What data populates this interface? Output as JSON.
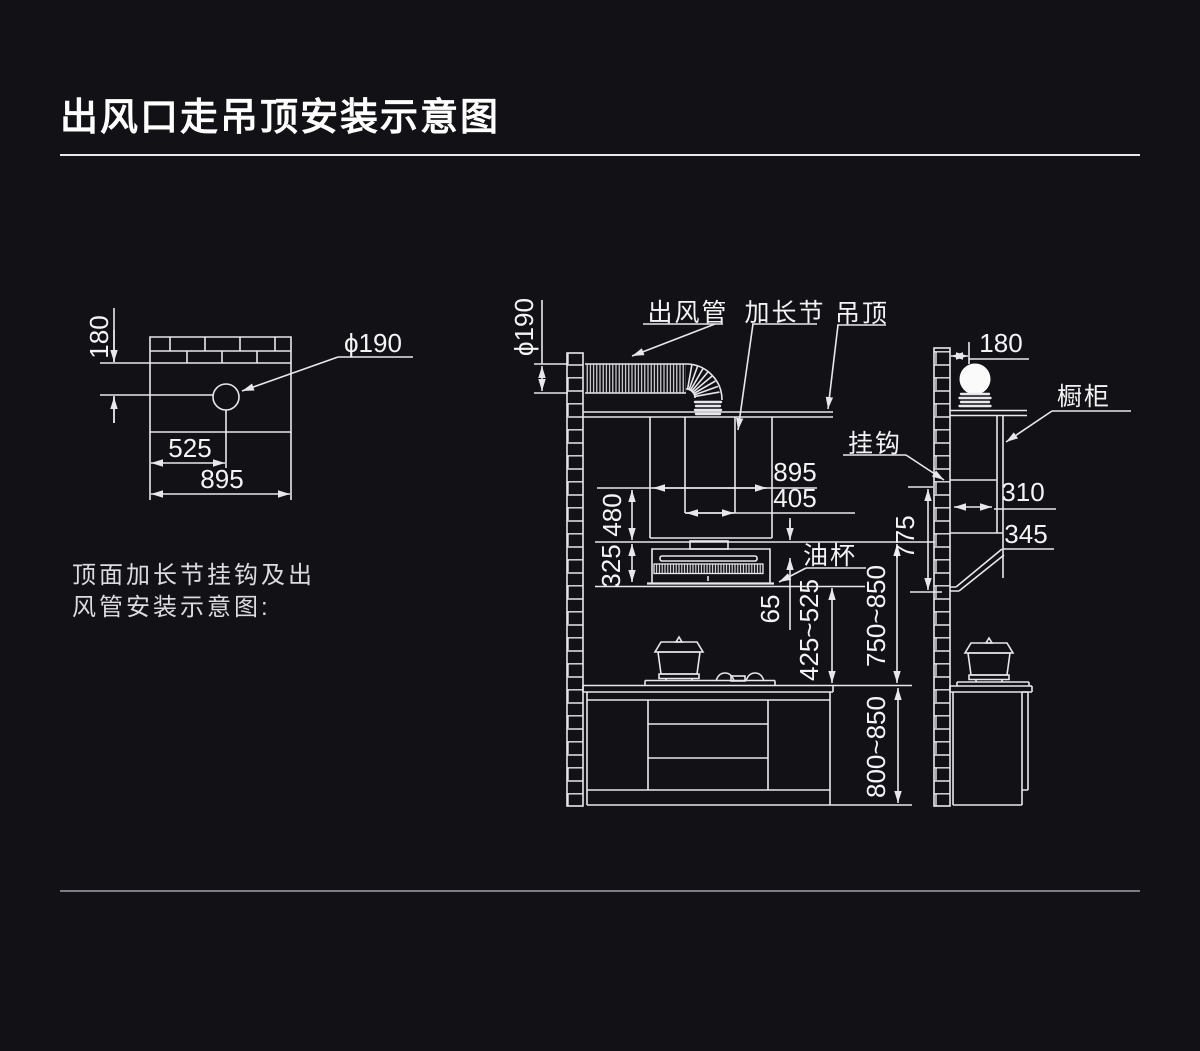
{
  "header": {
    "title": "出风口走吊顶安装示意图"
  },
  "note": {
    "line1": "顶面加长节挂钩及出",
    "line2": "风管安装示意图:"
  },
  "left_diagram": {
    "dim_wall_to_center": "180",
    "dim_hole_offset": "525",
    "dim_width": "895",
    "hole_diameter": "ϕ190"
  },
  "main_diagram": {
    "duct_diameter": "ϕ190",
    "label_outlet_duct": "出风管",
    "label_extension": "加长节",
    "label_ceiling": "吊顶",
    "label_hook": "挂钩",
    "label_oil_cup": "油杯",
    "dim_hood_width": "895",
    "dim_duct_width": "405",
    "dim_chimney_height": "480",
    "dim_hood_height": "325",
    "dim_gap": "65",
    "dim_hood_to_counter": "425~525",
    "dim_top_to_counter": "750~850",
    "dim_counter_height": "800~850",
    "dim_hook_height": "775"
  },
  "right_diagram": {
    "dim_wall_offset": "180",
    "label_cabinet": "橱柜",
    "dim_cabinet_depth": "310",
    "dim_bottom_depth": "345"
  },
  "colors": {
    "background": "#121216",
    "line": "#e8e8ec",
    "text": "#f4f4f6",
    "separator": "#7c7c84"
  }
}
